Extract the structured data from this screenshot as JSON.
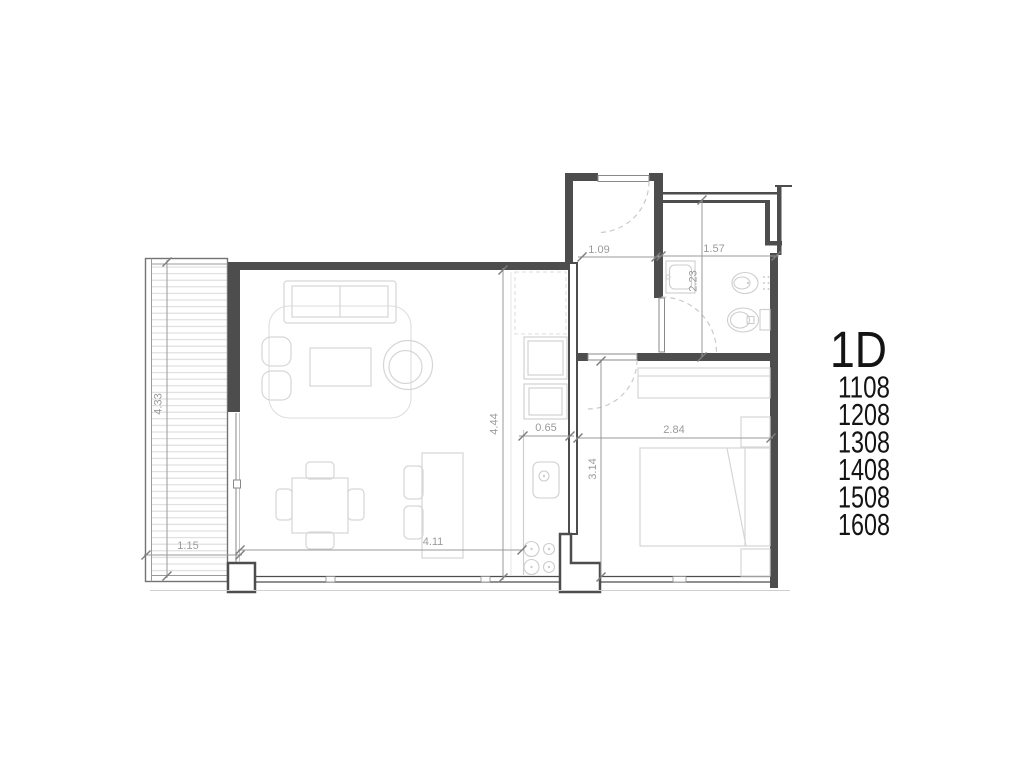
{
  "plan": {
    "unit_type": "1D",
    "unit_numbers": [
      "1108",
      "1208",
      "1308",
      "1408",
      "1508",
      "1608"
    ],
    "dimensions": {
      "terrace_length": "4.33",
      "terrace_width": "1.15",
      "living_width": "4.11",
      "living_depth": "4.44",
      "kitchen_counter": "0.65",
      "entry_width": "1.09",
      "bathroom_width": "1.57",
      "bathroom_depth": "2.23",
      "bedroom_width": "2.84",
      "bedroom_depth": "3.14"
    },
    "colors": {
      "wall": "#4d4d4d",
      "dimension_line": "#9a9a9a",
      "dimension_text": "#9b9b9b",
      "furniture_outline": "#d6d6d6",
      "fixture_outline": "#cdcdcd",
      "door_swing": "#cfc9c3",
      "label_text": "#141414",
      "background": "#ffffff"
    }
  }
}
